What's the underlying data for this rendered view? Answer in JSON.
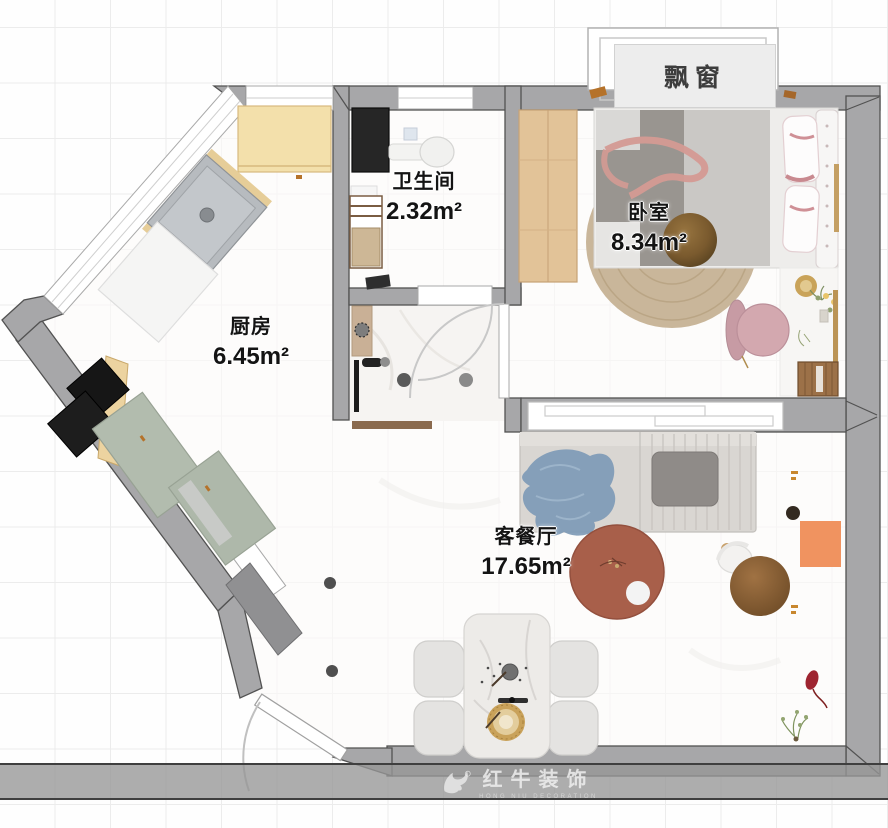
{
  "plan": {
    "bay_window_label": "飘窗",
    "rooms": [
      {
        "name": "卫生间",
        "area": "2.32m²"
      },
      {
        "name": "卧室",
        "area": "8.34m²"
      },
      {
        "name": "厨房",
        "area": "6.45m²"
      },
      {
        "name": "客餐厅",
        "area": "17.65m²"
      }
    ]
  },
  "watermark": {
    "brand_cn": "红牛装饰",
    "brand_en": "HONG NIU DECORATION"
  },
  "palette": {
    "wall": "#a7a7a9",
    "wall_outline": "#525252",
    "wood_cabinet": "#f3e0ab",
    "green_cabinet": "#b2bcae",
    "terracotta_table": "#a85f4a",
    "orange_accent": "#f0945e",
    "rug_tan": "#c9b69a",
    "floor": "#fbfaf9",
    "grid": "#ececec",
    "label_text": "#141414"
  }
}
